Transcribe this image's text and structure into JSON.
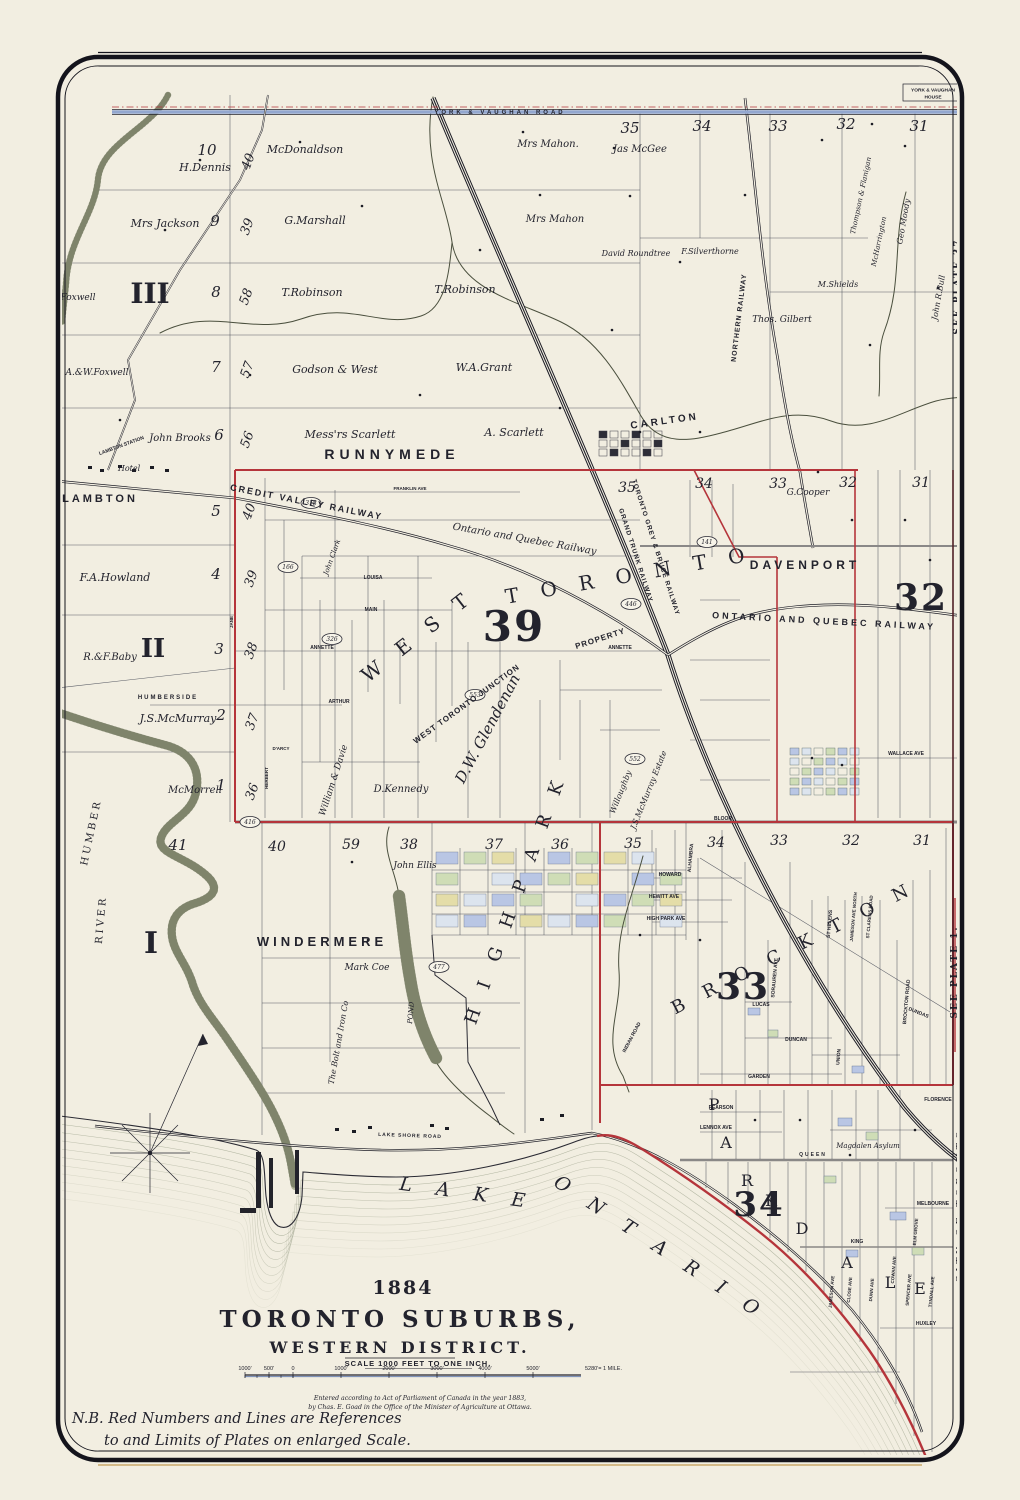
{
  "map": {
    "year": "1884",
    "title": "TORONTO SUBURBS,",
    "subtitle": "WESTERN DISTRICT.",
    "scale_label": "SCALE 1000 FEET TO ONE INCH.",
    "imprint1": "Entered according to Act of Parliament of Canada in the year 1883,",
    "imprint2": "by Chas. E. Goad in the Office of the Minister of Agriculture at Ottawa.",
    "note1": "N.B. Red Numbers and Lines are References",
    "note2": "to and Limits of Plates on enlarged Scale.",
    "house_line1": "YORK & VAUGHAN",
    "house_line2": "HOUSE"
  },
  "colors": {
    "paper": "#f2eee1",
    "ink": "#23232d",
    "red": "#b5353b",
    "red_big": "#d63b3e",
    "water": "#8e927b",
    "blue_road": "#93a7cf"
  },
  "scale": {
    "bar_y": 1375,
    "x_start": 245,
    "x_end": 581,
    "ticks": [
      {
        "label": "1000'",
        "x": 245
      },
      {
        "label": "500'",
        "x": 269
      },
      {
        "label": "0",
        "x": 293
      },
      {
        "label": "1000'",
        "x": 341
      },
      {
        "label": "2000'",
        "x": 389
      },
      {
        "label": "3000'",
        "x": 437
      },
      {
        "label": "4000'",
        "x": 485
      },
      {
        "label": "5000'",
        "x": 533
      },
      {
        "label": "5280'= 1 MILE.",
        "x": 585
      }
    ]
  },
  "badges": [
    [
      "446",
      631,
      604
    ],
    [
      "166",
      288,
      567
    ],
    [
      "326",
      332,
      639
    ],
    [
      "553",
      475,
      695
    ],
    [
      "552",
      635,
      759
    ],
    [
      "416",
      250,
      822
    ],
    [
      "477",
      439,
      967
    ],
    [
      "141",
      707,
      542
    ],
    [
      "318",
      311,
      503
    ]
  ],
  "labels": [
    [
      "10",
      207,
      155,
      "num",
      15
    ],
    [
      "H.Dennis",
      205,
      171,
      "name",
      11
    ],
    [
      "40",
      252,
      163,
      "num",
      13,
      -70
    ],
    [
      "McDonaldson",
      305,
      153,
      "name",
      11
    ],
    [
      "Mrs Jackson",
      165,
      227,
      "name",
      11
    ],
    [
      "9",
      215,
      226,
      "num",
      15
    ],
    [
      "39",
      251,
      228,
      "num",
      13,
      -70
    ],
    [
      "G.Marshall",
      315,
      224,
      "name",
      11
    ],
    [
      "A.&W.Foxwell",
      64,
      300,
      "name",
      9
    ],
    [
      "III",
      150,
      303,
      "big",
      28
    ],
    [
      "8",
      216,
      297,
      "num",
      15
    ],
    [
      "58",
      250,
      298,
      "num",
      13,
      -70
    ],
    [
      "T.Robinson",
      312,
      296,
      "name",
      11
    ],
    [
      "T.Robinson",
      465,
      293,
      "name",
      11
    ],
    [
      "A.&W.Foxwell",
      97,
      375,
      "name",
      9
    ],
    [
      "7",
      216,
      372,
      "num",
      15
    ],
    [
      "57",
      251,
      371,
      "num",
      13,
      -70
    ],
    [
      "Godson & West",
      335,
      373,
      "name",
      11
    ],
    [
      "W.A.Grant",
      484,
      371,
      "name",
      11
    ],
    [
      "John Brooks",
      180,
      441,
      "name",
      10
    ],
    [
      "6",
      219,
      440,
      "num",
      15
    ],
    [
      "56",
      251,
      441,
      "num",
      13,
      -70
    ],
    [
      "Mess'rs Scarlett",
      350,
      438,
      "name",
      11
    ],
    [
      "A. Scarlett",
      514,
      436,
      "name",
      11
    ],
    [
      "RUNNYMEDE",
      392,
      459,
      "caps",
      14,
      0,
      5
    ],
    [
      "Mrs Mahon.",
      548,
      147,
      "name",
      10
    ],
    [
      "Mrs Mahon",
      555,
      222,
      "name",
      10
    ],
    [
      "35",
      630,
      133,
      "num",
      15
    ],
    [
      "Jas McGee",
      640,
      152,
      "name",
      10
    ],
    [
      "34",
      702,
      131,
      "num",
      15
    ],
    [
      "33",
      778,
      131,
      "num",
      15
    ],
    [
      "32",
      846,
      129,
      "num",
      15
    ],
    [
      "31",
      919,
      131,
      "num",
      15
    ],
    [
      "David Roundtree",
      636,
      256,
      "name",
      8
    ],
    [
      "F.Silverthorne",
      710,
      254,
      "name",
      8
    ],
    [
      "Thompson & Flanigan",
      863,
      196,
      "name",
      7,
      -78
    ],
    [
      "McHarrington",
      881,
      242,
      "name",
      7,
      -78
    ],
    [
      "Geo Moody",
      906,
      222,
      "name",
      8,
      -80
    ],
    [
      "M.Shields",
      838,
      287,
      "name",
      8
    ],
    [
      "Thos. Gilbert",
      782,
      322,
      "name",
      9
    ],
    [
      "John R.Bull",
      941,
      298,
      "name",
      8,
      -80
    ],
    [
      "NORTHERN RAILWAY",
      741,
      318,
      "rail",
      7,
      -83,
      1
    ],
    [
      "YORK & VAUGHAN ROAD",
      500,
      114,
      "road",
      6,
      0,
      3
    ],
    [
      "SEE PLATE 37.",
      960,
      284,
      "redv",
      9,
      -90,
      2
    ],
    [
      "CARLTON",
      665,
      424,
      "caps",
      10,
      -8,
      3
    ],
    [
      "LAMBTON STATION",
      122,
      447,
      "tiny",
      5,
      -20
    ],
    [
      "Hotel",
      129,
      471,
      "name",
      8
    ],
    [
      "LAMBTON",
      100,
      502,
      "caps",
      11,
      0,
      3
    ],
    [
      "CREDIT VALLEY RAILWAY",
      306,
      505,
      "rail",
      9,
      11,
      2
    ],
    [
      "5",
      216,
      516,
      "num",
      15
    ],
    [
      "40",
      253,
      513,
      "num",
      13,
      -70
    ],
    [
      "F.A.Howland",
      115,
      581,
      "name",
      11
    ],
    [
      "4",
      216,
      579,
      "num",
      15
    ],
    [
      "39",
      255,
      580,
      "num",
      13,
      -70
    ],
    [
      "II",
      153,
      657,
      "big",
      26
    ],
    [
      "R.&F.Baby",
      110,
      660,
      "name",
      10
    ],
    [
      "3",
      219,
      654,
      "num",
      15
    ],
    [
      "38",
      255,
      652,
      "num",
      13,
      -70
    ],
    [
      "HUMBERSIDE",
      168,
      699,
      "tiny",
      6,
      0,
      2
    ],
    [
      "J.S.McMurray",
      178,
      722,
      "name",
      11
    ],
    [
      "2",
      221,
      720,
      "num",
      15
    ],
    [
      "37",
      256,
      723,
      "num",
      13,
      -70
    ],
    [
      "McMorrell",
      195,
      793,
      "name",
      10
    ],
    [
      "1",
      221,
      790,
      "num",
      15
    ],
    [
      "36",
      256,
      793,
      "num",
      13,
      -70
    ],
    [
      "Ontario and Quebec Railway",
      524,
      542,
      "name",
      10,
      10
    ],
    [
      "35",
      627,
      492,
      "num",
      14
    ],
    [
      "34",
      704,
      488,
      "num",
      14
    ],
    [
      "33",
      778,
      488,
      "num",
      14
    ],
    [
      "G.Cooper",
      808,
      495,
      "name",
      9
    ],
    [
      "32",
      848,
      487,
      "num",
      14
    ],
    [
      "31",
      921,
      487,
      "num",
      14
    ],
    [
      "DAVENPORT",
      805,
      569,
      "caps",
      12,
      0,
      4
    ],
    [
      "32",
      921,
      610,
      "redbig",
      36
    ],
    [
      "ONTARIO AND QUEBEC RAILWAY",
      824,
      624,
      "rail",
      9,
      3,
      3
    ],
    [
      "TORONTO GREY & BRUCE RAILWAY",
      654,
      548,
      "rail",
      6.5,
      72,
      1
    ],
    [
      "GRAND TRUNK RAILWAY",
      634,
      556,
      "rail",
      6.5,
      72,
      1
    ],
    [
      "W E S T",
      422,
      641,
      "bigcaps",
      20,
      -38
    ],
    [
      "T O R O N T O",
      630,
      582,
      "bigcaps",
      20,
      -10
    ],
    [
      "39",
      514,
      641,
      "redbig",
      42
    ],
    [
      "WEST TORONTO JUNCTION",
      468,
      706,
      "rail",
      8,
      -36,
      1
    ],
    [
      "PROPERTY",
      601,
      641,
      "rail",
      8,
      -18,
      1
    ],
    [
      "D.W. Glendenan",
      492,
      731,
      "bigname",
      15,
      -62
    ],
    [
      "John Clark",
      334,
      558,
      "name",
      7,
      -70
    ],
    [
      "William & Davie",
      336,
      781,
      "name",
      9,
      -72
    ],
    [
      "D.Kennedy",
      401,
      792,
      "name",
      10
    ],
    [
      "Willoughby",
      623,
      793,
      "name",
      8,
      -68
    ],
    [
      "J.S.McMurray Estate",
      651,
      791,
      "name",
      8,
      -68
    ],
    [
      "ANNETTE",
      322,
      649,
      "tiny",
      5
    ],
    [
      "ANNETTE",
      620,
      649,
      "tiny",
      5
    ],
    [
      "LOUISA",
      373,
      579,
      "tiny",
      5
    ],
    [
      "MAIN",
      371,
      611,
      "tiny",
      5
    ],
    [
      "ARTHUR",
      339,
      703,
      "tiny",
      5
    ],
    [
      "FRANKLIN AVE",
      410,
      490,
      "tiny",
      4.5
    ],
    [
      "JANE",
      233,
      622,
      "tiny",
      4.5,
      -90
    ],
    [
      "D'ARCY",
      281,
      750,
      "tiny",
      4.5
    ],
    [
      "HERBERT",
      268,
      778,
      "tiny",
      4.5,
      -90
    ],
    [
      "WALLACE AVE",
      906,
      755,
      "tiny",
      5
    ],
    [
      "BLOOR",
      723,
      820,
      "tiny",
      5
    ],
    [
      "41",
      178,
      850,
      "num",
      15
    ],
    [
      "40",
      277,
      851,
      "num",
      14
    ],
    [
      "59",
      351,
      849,
      "num",
      14
    ],
    [
      "38",
      409,
      849,
      "num",
      14
    ],
    [
      "John Ellis",
      415,
      868,
      "name",
      9
    ],
    [
      "37",
      494,
      849,
      "num",
      14
    ],
    [
      "36",
      560,
      849,
      "num",
      14
    ],
    [
      "35",
      633,
      848,
      "num",
      14
    ],
    [
      "34",
      716,
      847,
      "num",
      14
    ],
    [
      "33",
      779,
      845,
      "num",
      14
    ],
    [
      "32",
      851,
      845,
      "num",
      14
    ],
    [
      "31",
      922,
      845,
      "num",
      14
    ],
    [
      "WINDERMERE",
      322,
      946,
      "caps",
      13,
      0,
      4
    ],
    [
      "Mark Coe",
      367,
      970,
      "name",
      9
    ],
    [
      "I",
      151,
      953,
      "big",
      30
    ],
    [
      "RIVER",
      104,
      920,
      "rivlb",
      10,
      -85,
      3
    ],
    [
      "HUMBER",
      94,
      833,
      "rivlb",
      10,
      -78,
      3
    ],
    [
      "H I G H   P A R K",
      521,
      901,
      "bigcaps",
      18,
      -70
    ],
    [
      "POND",
      413,
      1013,
      "name",
      7,
      -85
    ],
    [
      "The Bolt and Iron Co",
      341,
      1043,
      "name",
      8,
      -80
    ],
    [
      "B R O C K T O N",
      796,
      953,
      "bigcaps",
      18,
      -27
    ],
    [
      "33",
      743,
      999,
      "redbig",
      36
    ],
    [
      "HOWARD",
      670,
      876,
      "tiny",
      5
    ],
    [
      "HEWITT AVE",
      664,
      898,
      "tiny",
      5
    ],
    [
      "HIGH PARK AVE",
      666,
      920,
      "tiny",
      5
    ],
    [
      "ALHAMBRA",
      692,
      858,
      "tiny",
      5,
      -85
    ],
    [
      "SORAUREN AVE",
      776,
      978,
      "tiny",
      5,
      -85
    ],
    [
      "ST HELENS",
      831,
      924,
      "tiny",
      5,
      -85
    ],
    [
      "JAMESON AVE NORTH",
      855,
      917,
      "tiny",
      4.5,
      -85
    ],
    [
      "ST CLARENS ROAD",
      871,
      917,
      "tiny",
      4.5,
      -85
    ],
    [
      "BROCKTON ROAD",
      908,
      1002,
      "tiny",
      5,
      -85
    ],
    [
      "DUNDAS",
      918,
      1014,
      "tiny",
      5,
      22
    ],
    [
      "LUCAS",
      761,
      1006,
      "tiny",
      5
    ],
    [
      "DUNCAN",
      796,
      1041,
      "tiny",
      5
    ],
    [
      "UNION",
      840,
      1057,
      "tiny",
      5,
      -85
    ],
    [
      "GARDEN",
      759,
      1078,
      "tiny",
      5
    ],
    [
      "INDIAN ROAD",
      633,
      1038,
      "tiny",
      5,
      -62
    ],
    [
      "SEE PLATE 1.",
      957,
      972,
      "redv",
      9,
      -90,
      2
    ],
    [
      "CITY OF TORONTO",
      963,
      1205,
      "border",
      9.5,
      -90,
      4
    ],
    [
      "QUEEN",
      813,
      1156,
      "tiny",
      5,
      0,
      2
    ],
    [
      "KING",
      857,
      1243,
      "tiny",
      5
    ],
    [
      "PEARSON",
      721,
      1109,
      "tiny",
      5
    ],
    [
      "LENNOX AVE",
      716,
      1129,
      "tiny",
      5
    ],
    [
      "Magdalen Asylum",
      868,
      1148,
      "name",
      7
    ],
    [
      "FLORENCE",
      938,
      1101,
      "tiny",
      5
    ],
    [
      "MELBOURNE",
      933,
      1205,
      "tiny",
      5
    ],
    [
      "ELM GROVE",
      917,
      1232,
      "tiny",
      4.5,
      -85
    ],
    [
      "COWAN AVE",
      895,
      1270,
      "tiny",
      4.5,
      -85
    ],
    [
      "SPENCER AVE",
      910,
      1290,
      "tiny",
      4.5,
      -85
    ],
    [
      "TYNDALL AVE",
      933,
      1292,
      "tiny",
      4.5,
      -85
    ],
    [
      "HUXLEY",
      926,
      1325,
      "tiny",
      5
    ],
    [
      "JAMESON AVE",
      833,
      1292,
      "tiny",
      4.5,
      -85
    ],
    [
      "CLOSE AVE",
      851,
      1290,
      "tiny",
      4.5,
      -85
    ],
    [
      "DUNN AVE",
      873,
      1290,
      "tiny",
      4.5,
      -85
    ],
    [
      "34",
      759,
      1216,
      "redbig",
      34
    ],
    [
      "P",
      714,
      1110,
      "pk",
      16
    ],
    [
      "A",
      726,
      1148,
      "pk",
      16
    ],
    [
      "R",
      747,
      1186,
      "pk",
      16
    ],
    [
      "K",
      771,
      1206,
      "pk",
      16
    ],
    [
      "D",
      802,
      1234,
      "pk",
      16
    ],
    [
      "A",
      847,
      1268,
      "pk",
      16
    ],
    [
      "L",
      890,
      1288,
      "pk",
      16
    ],
    [
      "E",
      920,
      1294,
      "pk",
      16
    ],
    [
      "LAKE SHORE ROAD",
      410,
      1137,
      "tiny",
      5,
      2,
      1
    ],
    [
      "L A K E",
      466,
      1199,
      "lake",
      19,
      8
    ],
    [
      "O N T A R I O",
      657,
      1253,
      "lake",
      19,
      33
    ]
  ]
}
